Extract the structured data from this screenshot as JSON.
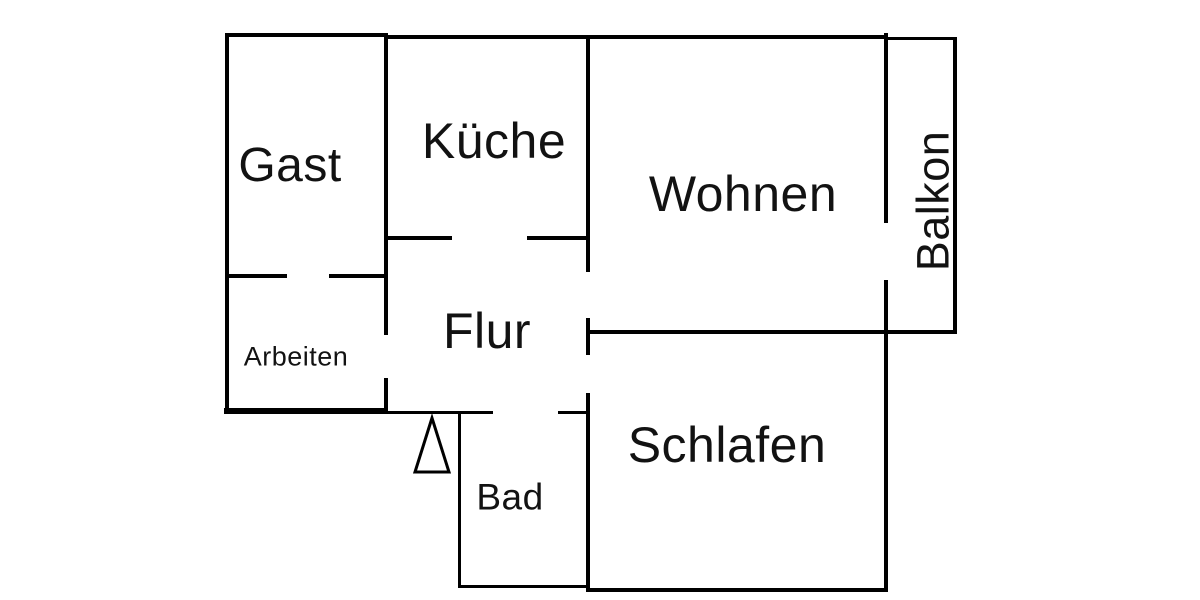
{
  "floorplan": {
    "title": "apartment-floor-plan",
    "colors": {
      "background": "#ffffff",
      "wall": "#000000",
      "text": "#121212"
    },
    "rooms": {
      "gast": {
        "label": "Gast"
      },
      "kueche": {
        "label": "Küche"
      },
      "wohnen": {
        "label": "Wohnen"
      },
      "balkon": {
        "label": "Balkon"
      },
      "arbeiten": {
        "label": "Arbeiten"
      },
      "flur": {
        "label": "Flur"
      },
      "bad": {
        "label": "Bad"
      },
      "schlafen": {
        "label": "Schlafen"
      }
    },
    "icons": {
      "entrance_arrow": "triangle-up-outline"
    }
  }
}
